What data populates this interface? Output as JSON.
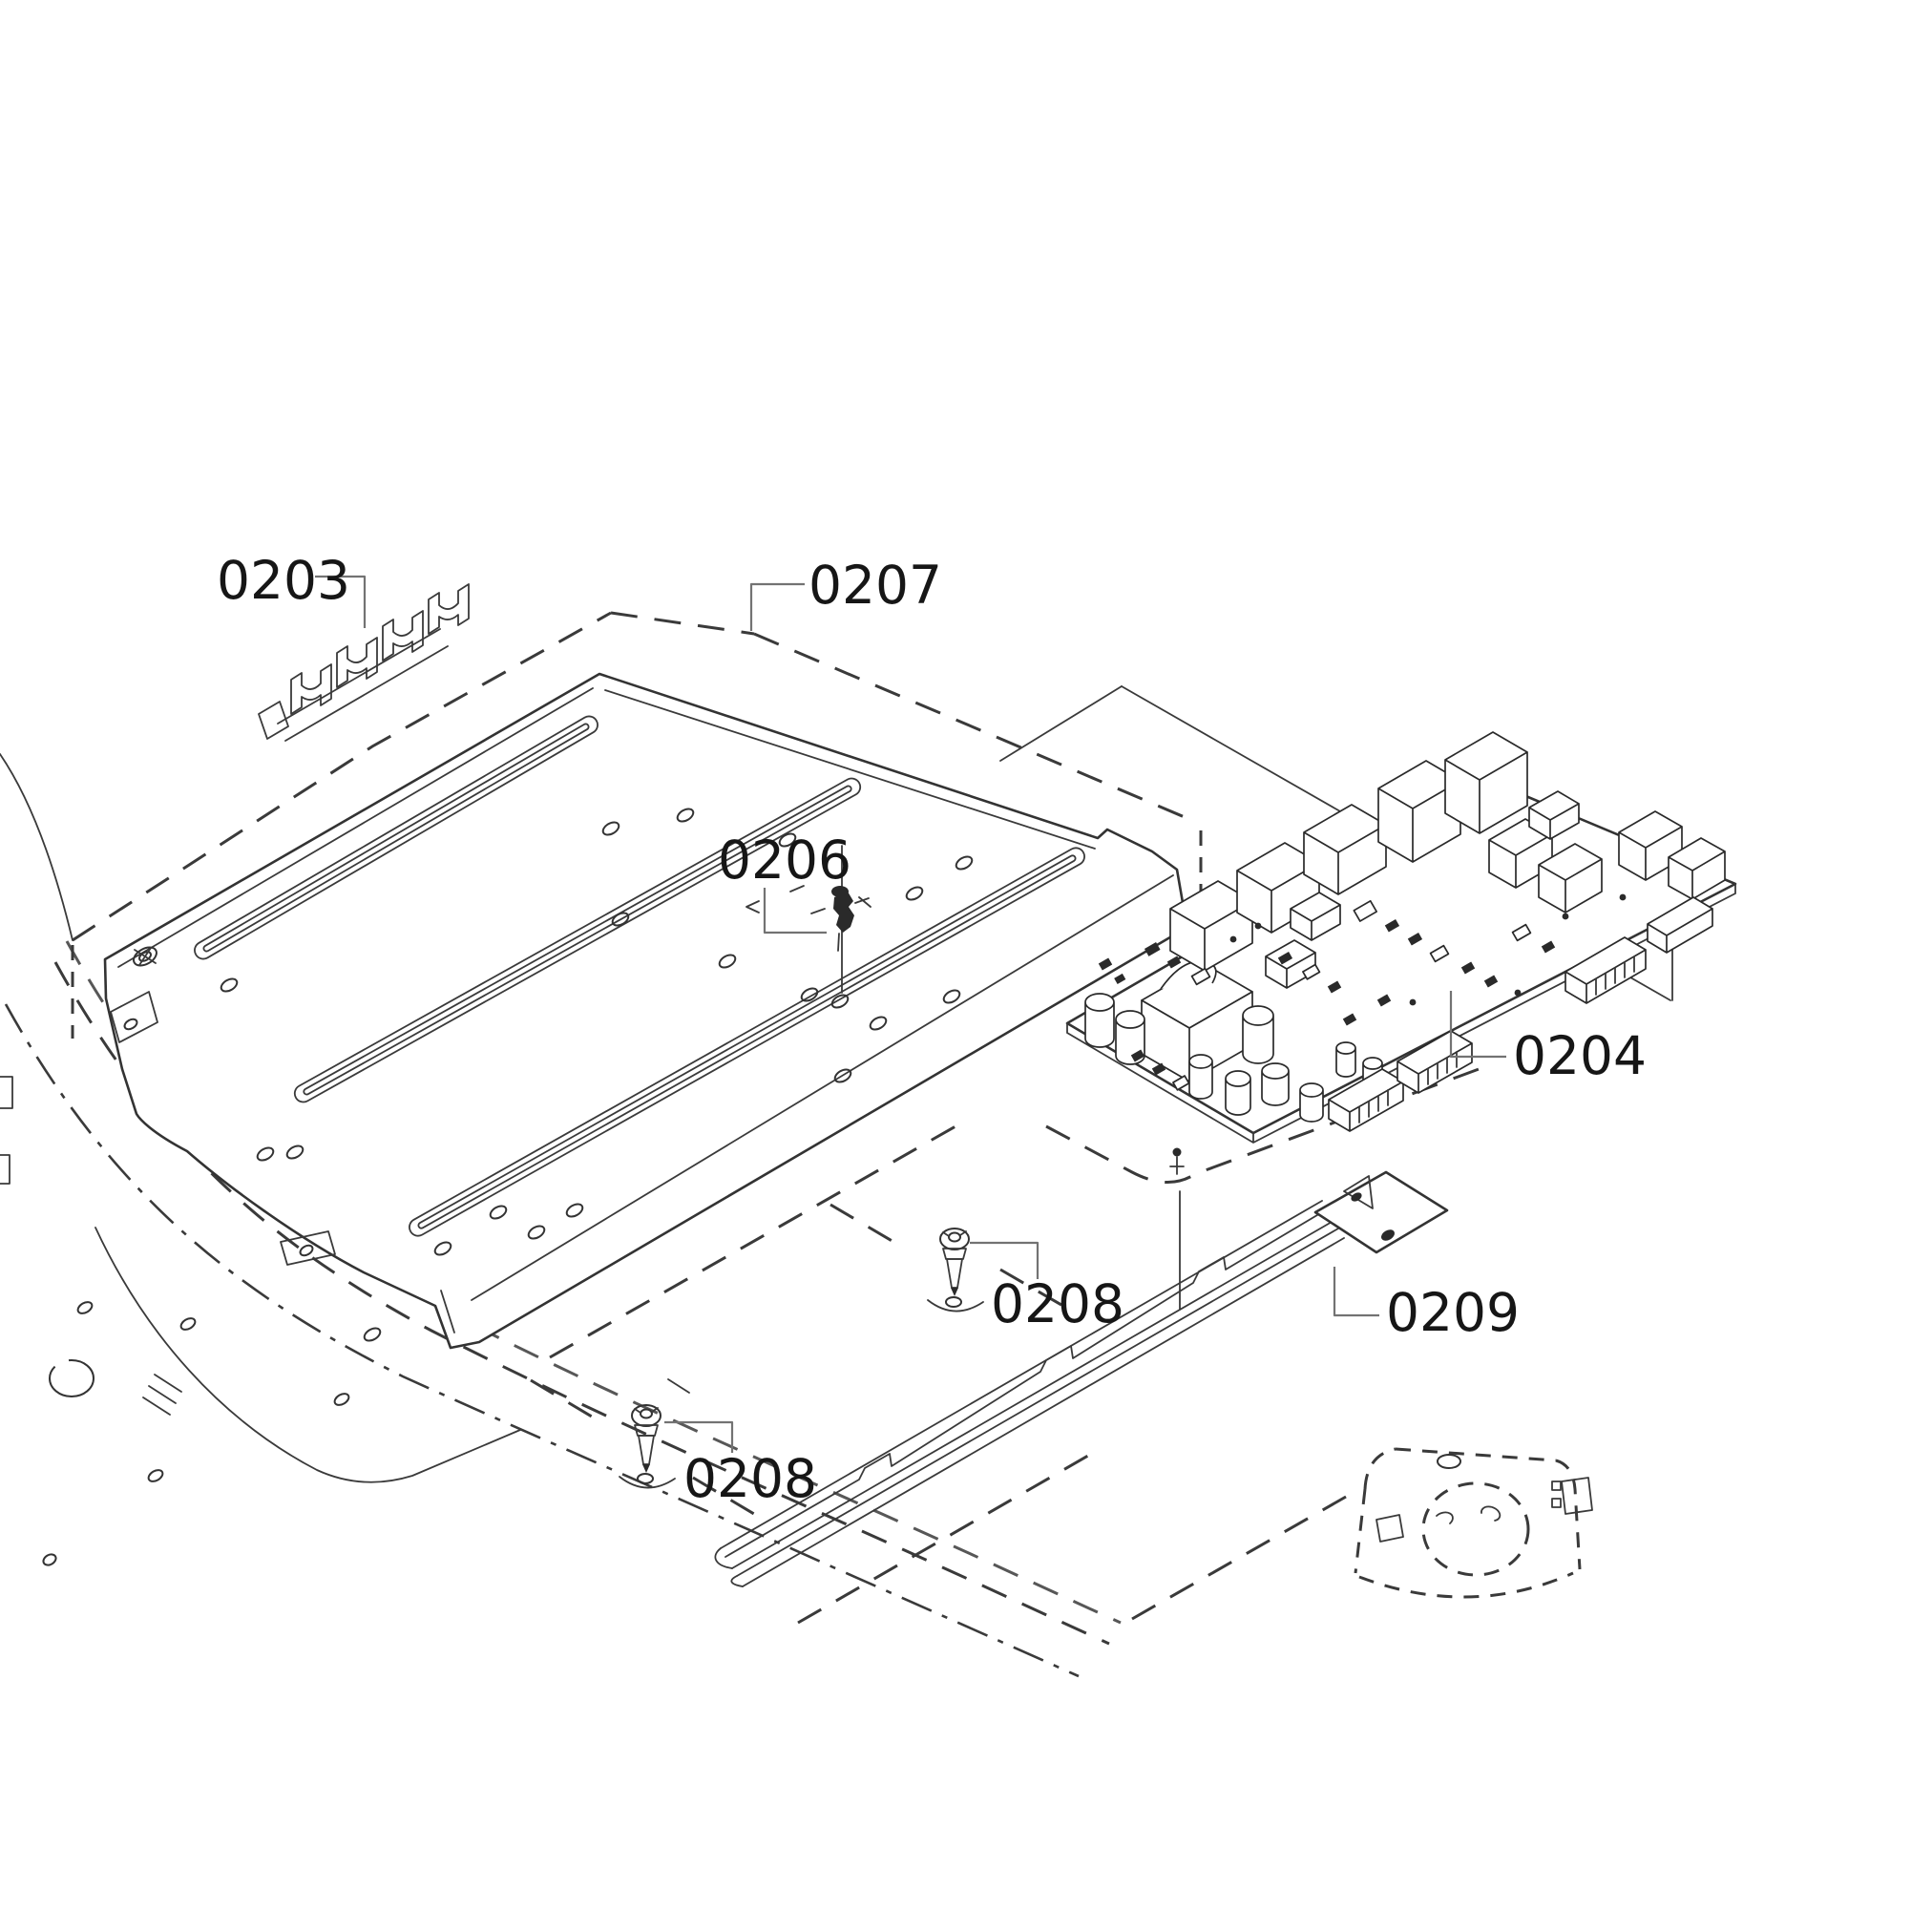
{
  "diagram": {
    "type": "exploded-parts-diagram",
    "background_color": "#ffffff",
    "line_color": "#333333",
    "leader_color": "#737373",
    "callout_instances": [
      "0203",
      "0207",
      "0206",
      "0204",
      "0208",
      "0209",
      "0208"
    ],
    "labels": {
      "l0203": "0203",
      "l0204": "0204",
      "l0206": "0206",
      "l0207": "0207",
      "l0208": "0208",
      "l0209": "0209"
    }
  }
}
